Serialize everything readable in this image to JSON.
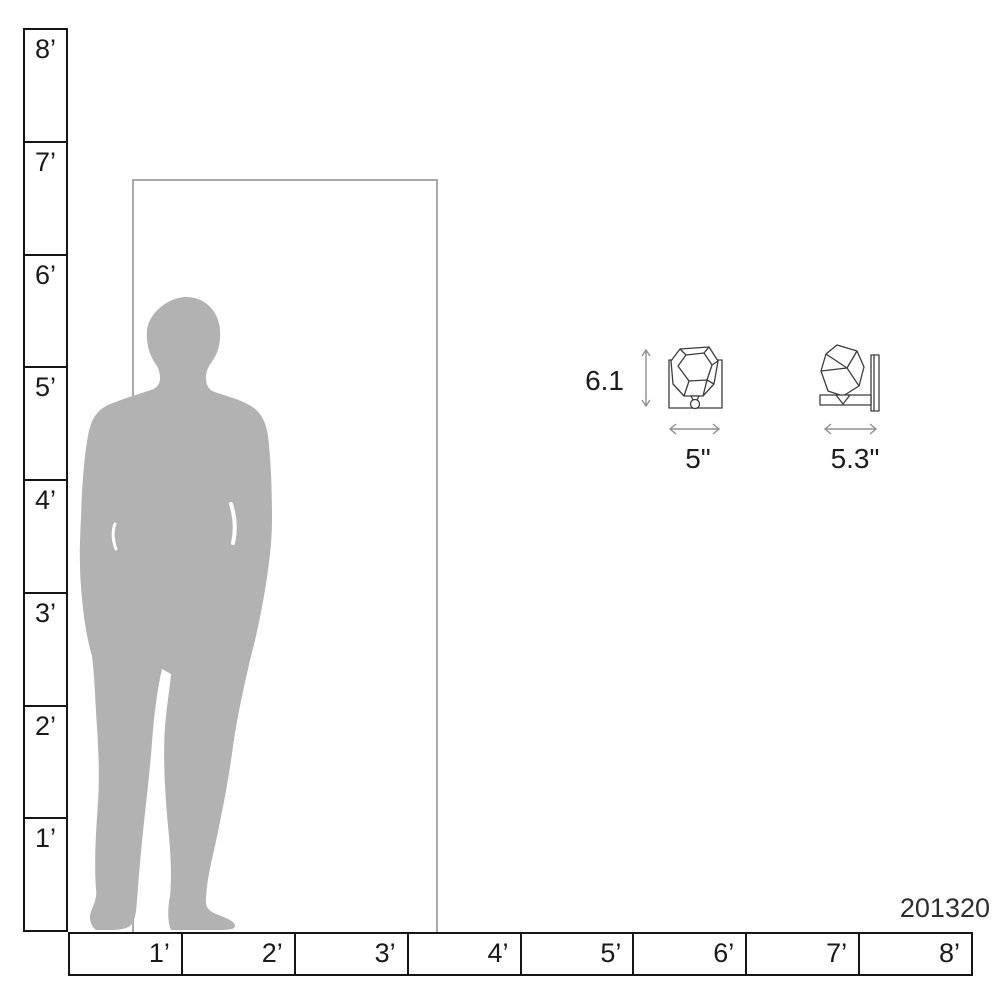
{
  "product": {
    "number": "201320"
  },
  "rulers": {
    "vertical": {
      "labels": [
        "8’",
        "7’",
        "6’",
        "5’",
        "4’",
        "3’",
        "2’",
        "1’"
      ]
    },
    "horizontal": {
      "labels": [
        "1’",
        "2’",
        "3’",
        "4’",
        "5’",
        "6’",
        "7’",
        "8’"
      ]
    }
  },
  "fixture": {
    "height_label": "6.1",
    "front_width_label": "5\"",
    "side_width_label": "5.3\""
  },
  "colors": {
    "silhouette": "#b2b2b2",
    "door_outline": "#a9a9a9",
    "ruler_border": "#161616",
    "label_text": "#1c1c1c",
    "arrow": "#8f8f8f",
    "fixture_line": "#3c3c3c",
    "background": "#ffffff"
  }
}
